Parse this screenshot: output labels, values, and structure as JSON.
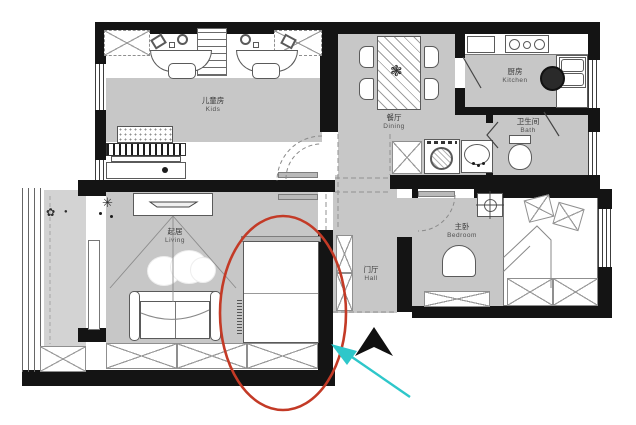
{
  "rooms": {
    "kids": {
      "cn": "儿童房",
      "en": "Kids"
    },
    "dining": {
      "cn": "餐厅",
      "en": "Dining"
    },
    "kitchen": {
      "cn": "厨房",
      "en": "Kitchen"
    },
    "bath": {
      "cn": "卫生间",
      "en": "Bath"
    },
    "living": {
      "cn": "起居",
      "en": "Living"
    },
    "hall": {
      "cn": "门厅",
      "en": "Hall"
    },
    "bedroom": {
      "cn": "主卧",
      "en": "Bedroom"
    }
  },
  "icons": {
    "balcony_plant": "✿",
    "balcony_plant_small": "●",
    "ceiling_lamp": "✳",
    "dining_plant": "❃"
  },
  "annotations": {
    "highlight_shape": "ellipse",
    "highlight_color": "#c33a26",
    "arrow_color": "#2ec7ca",
    "north_arrow_color": "#101010"
  },
  "colors": {
    "wall": "#141414",
    "floor": "#c7c7c7",
    "balcony_floor": "#d3d3d3",
    "furniture_outline": "#555555"
  }
}
